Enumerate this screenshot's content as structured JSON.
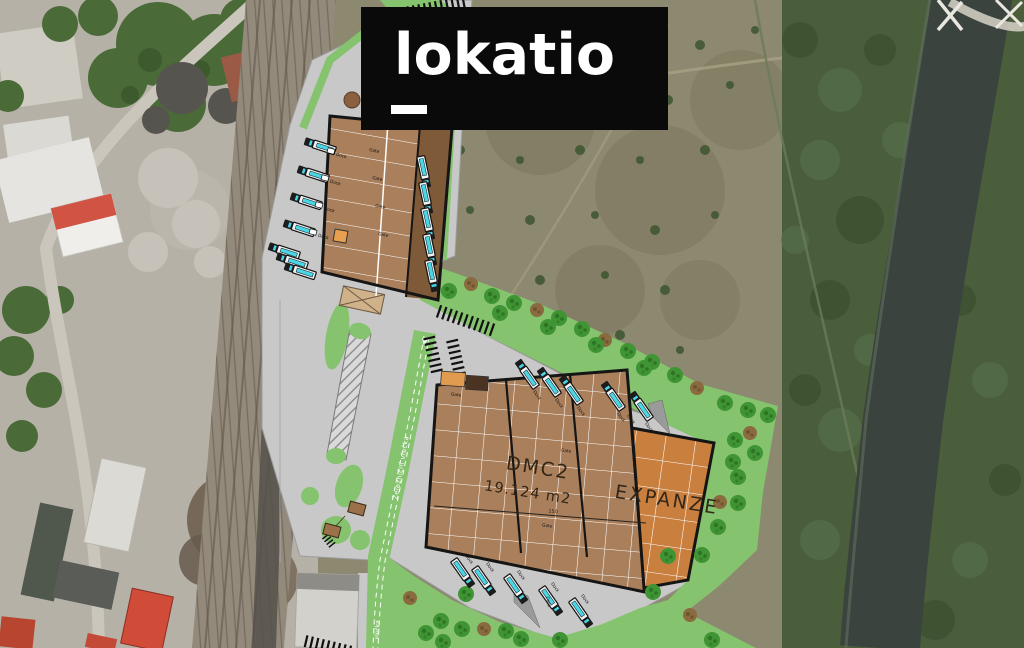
{
  "logo": {
    "text": "lokatio"
  },
  "site_plan": {
    "main_hall_name": "DMC2",
    "main_hall_area": "19.124 m2",
    "expansion_label": "EXPANZE",
    "dock_label": "Dock",
    "gate_label": "Gate",
    "rail_siding_label": "Železniční vlečka",
    "rail_siding_label_short": "vlečka",
    "dimension_label": "150",
    "colors": {
      "hall_fill": "#aa7f5b",
      "expansion_fill": "#c9803f",
      "paved_area": "#c8c8c8",
      "landscape_green": "#85c36e",
      "tree_green": "#3f9434",
      "outline_black": "#151515",
      "truck_cyan": "#49d6e6",
      "logo_background": "#0a0a0a",
      "logo_text": "#ffffff"
    }
  }
}
